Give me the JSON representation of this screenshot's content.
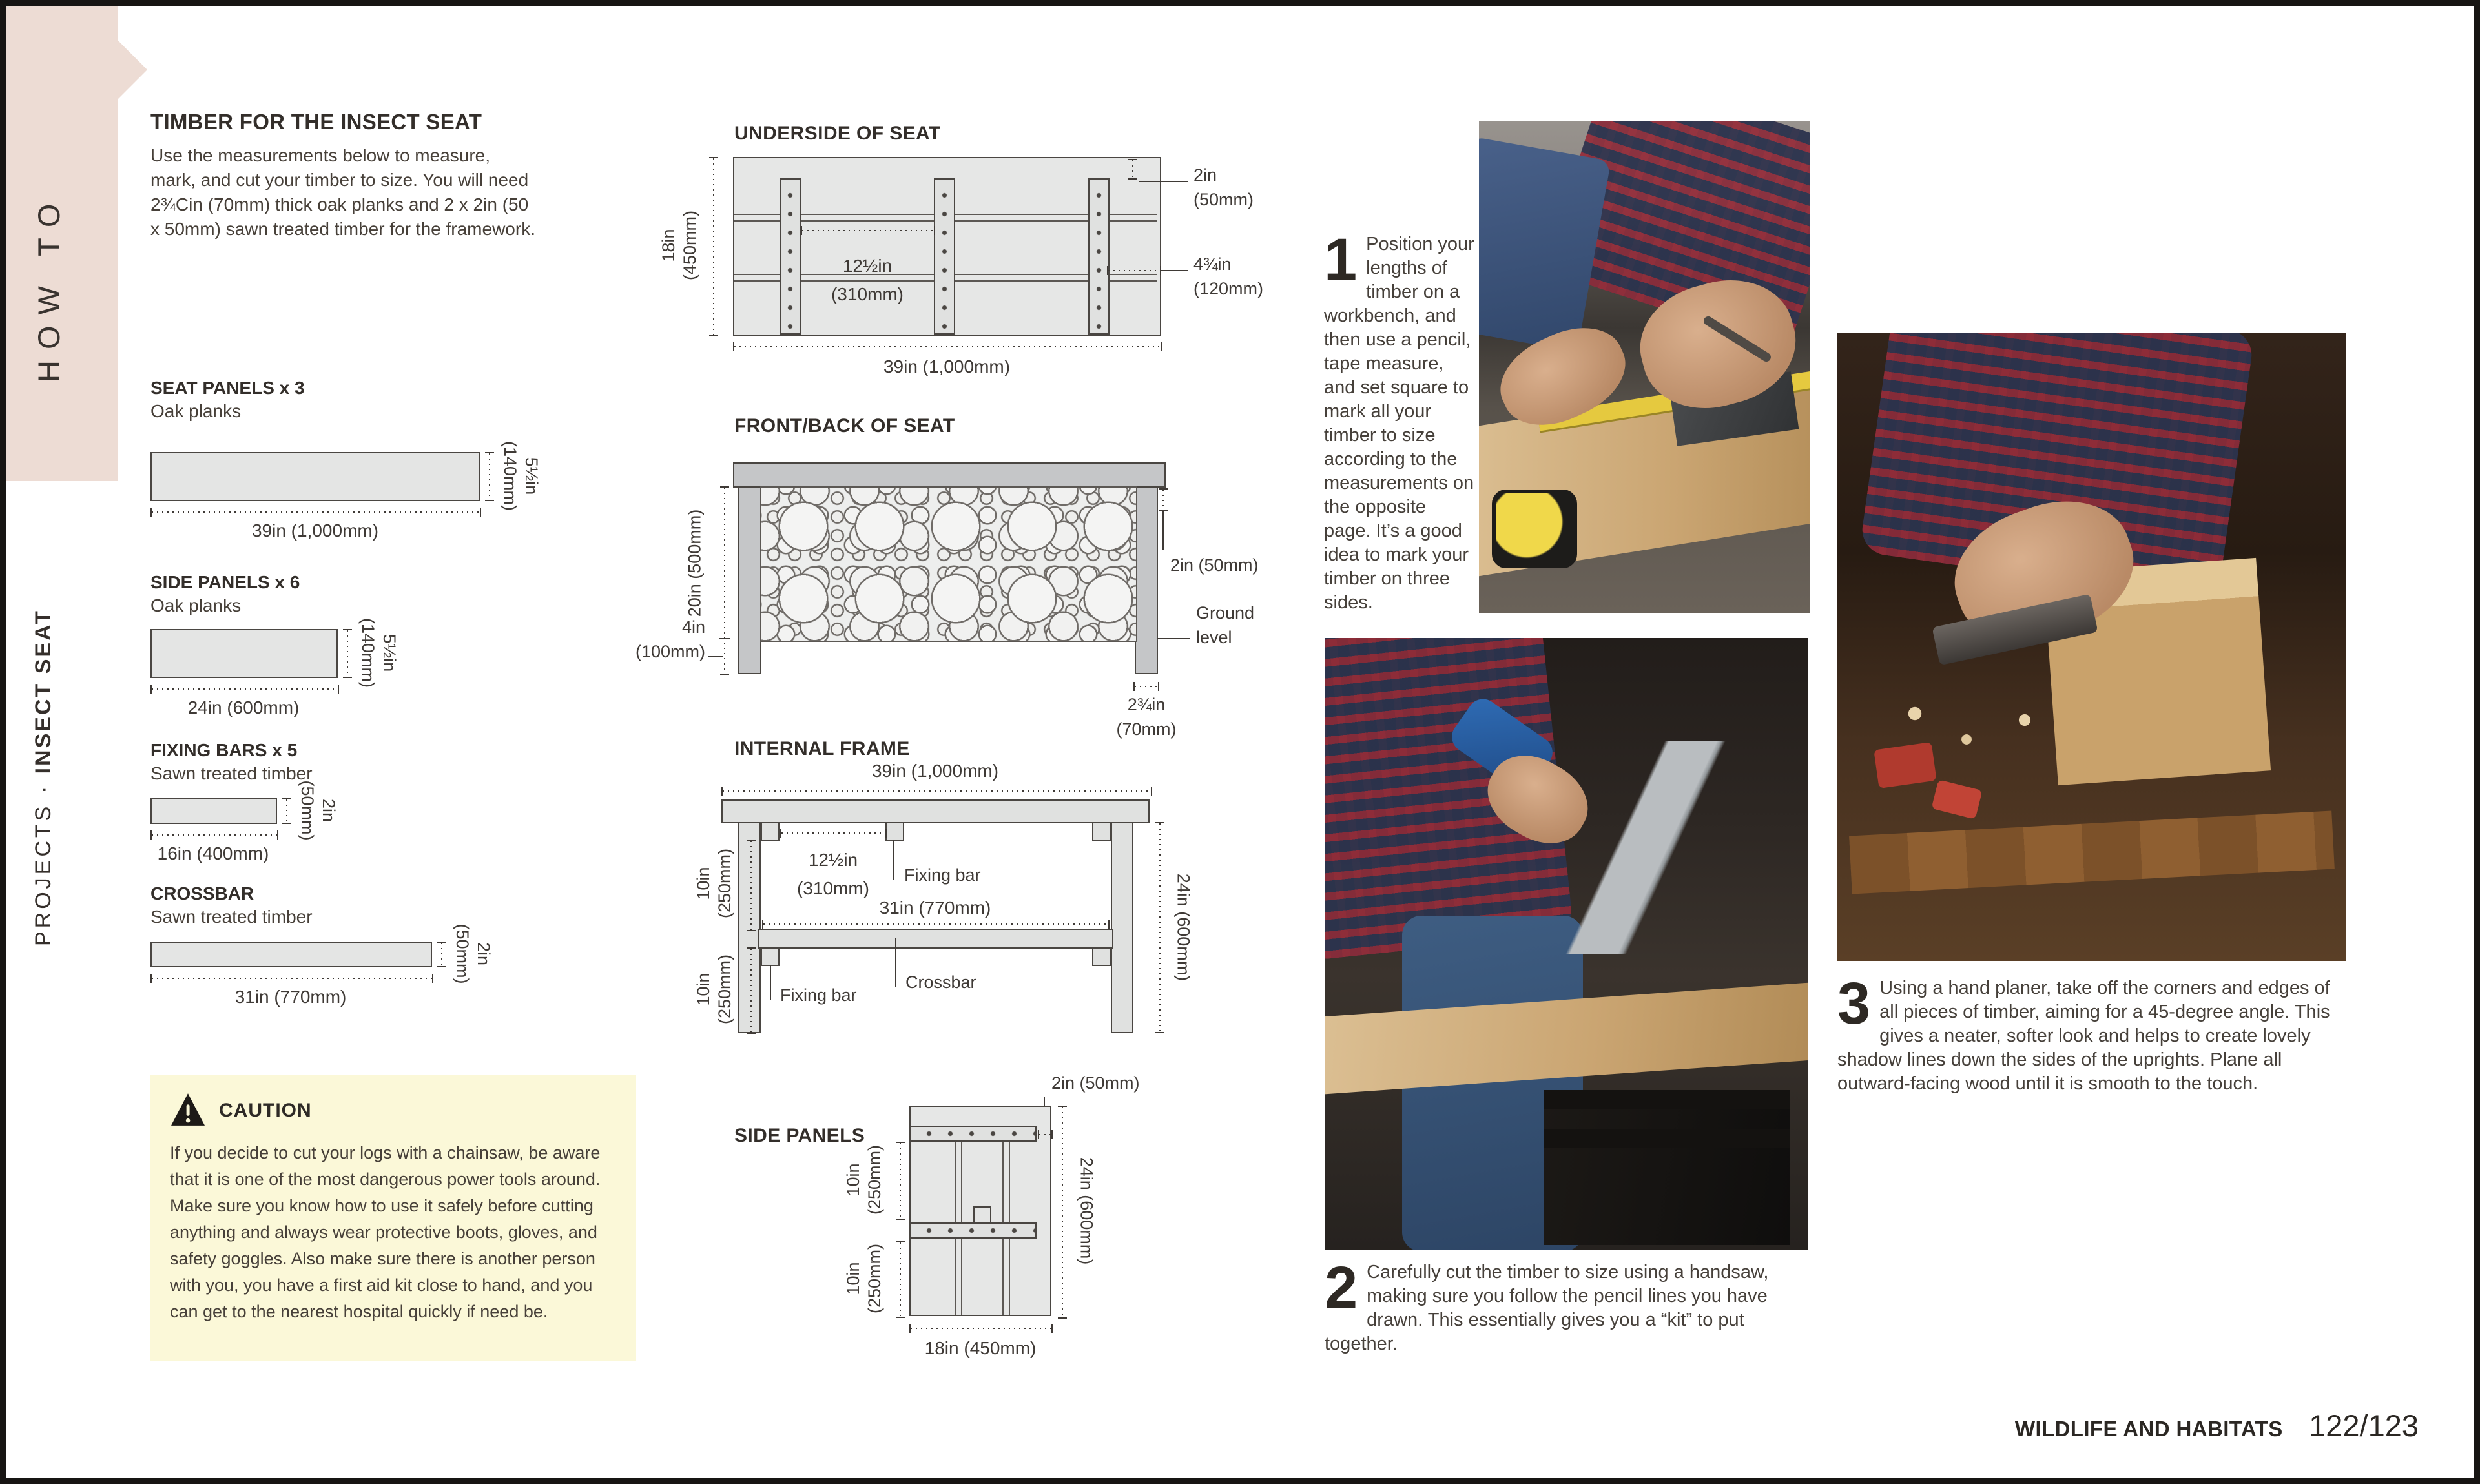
{
  "sidebar": {
    "ribbon_label": "HOW TO",
    "category": "PROJECTS",
    "separator": "·",
    "title": "INSECT SEAT"
  },
  "intro": {
    "heading": "TIMBER FOR THE INSECT SEAT",
    "body": "Use the measurements below to measure, mark, and cut your timber to size. You will need 2¾Cin (70mm) thick oak planks and 2 x 2in (50 x 50mm) sawn treated timber for the framework."
  },
  "cut_list": {
    "items": [
      {
        "name": "SEAT PANELS x 3",
        "material": "Oak planks",
        "length": "39in (1,000mm)",
        "w1": "5½in",
        "w2": "(140mm)"
      },
      {
        "name": "SIDE PANELS x 6",
        "material": "Oak planks",
        "length": "24in (600mm)",
        "w1": "5½in",
        "w2": "(140mm)"
      },
      {
        "name": "FIXING BARS x 5",
        "material": "Sawn treated timber",
        "length": "16in (400mm)",
        "w1": "2in",
        "w2": "(50mm)"
      },
      {
        "name": "CROSSBAR",
        "material": "Sawn treated timber",
        "length": "31in (770mm)",
        "w1": "2in",
        "w2": "(50mm)"
      }
    ]
  },
  "caution": {
    "title": "CAUTION",
    "body": "If you decide to cut your logs with a chainsaw, be aware that it is one of the most dangerous power tools around. Make sure you know how to use it safely before cutting anything and always wear protective boots, gloves, and safety goggles. Also make sure there is another person with you, you have a first aid kit close to hand, and you can get to the nearest hospital quickly if need be."
  },
  "underside": {
    "title": "UNDERSIDE OF SEAT",
    "h1": "18in",
    "h2": "(450mm)",
    "width": "39in (1,000mm)",
    "sp1": "12½in",
    "sp2": "(310mm)",
    "gap1": "2in",
    "gap2": "(50mm)",
    "edge1": "4¾in",
    "edge2": "(120mm)"
  },
  "frontback": {
    "title": "FRONT/BACK OF SEAT",
    "panel_height": "20in (500mm)",
    "below1": "4in",
    "below2": "(100mm)",
    "thickness": "2in (50mm)",
    "ground1": "Ground",
    "ground2": "level",
    "leg1": "2¾in",
    "leg2": "(70mm)"
  },
  "internal": {
    "title": "INTERNAL FRAME",
    "width": "39in (1,000mm)",
    "sp1": "12½in",
    "sp2": "(310mm)",
    "fixing_bar_upper": "Fixing bar",
    "inner_width": "31in (770mm)",
    "crossbar": "Crossbar",
    "fixing_bar_lower": "Fixing bar",
    "u1": "10in",
    "u2": "(250mm)",
    "l1": "10in",
    "l2": "(250mm)",
    "height": "24in (600mm)"
  },
  "sidepanels": {
    "title": "SIDE PANELS",
    "top_gap": "2in (50mm)",
    "u1": "10in",
    "u2": "(250mm)",
    "l1": "10in",
    "l2": "(250mm)",
    "height": "24in (600mm)",
    "width": "18in (450mm)"
  },
  "steps": [
    {
      "number": "1",
      "text": "Position your lengths of timber on a workbench, and then use a pencil, tape measure, and set square to mark all your timber to size according to the measurements on the opposite page. It’s a good idea to mark your timber on three sides."
    },
    {
      "number": "2",
      "text": "Carefully cut the timber to size using a handsaw, making sure you follow the pencil lines you have drawn. This essentially gives you a “kit” to put together."
    },
    {
      "number": "3",
      "text": "Using a hand planer, take off the corners and edges of all pieces of timber, aiming for a 45-degree angle. This gives a neater, softer look and helps to create lovely shadow lines down the sides of the uprights. Plane all outward-facing wood until it is smooth to the touch."
    }
  ],
  "footer": {
    "section": "WILDLIFE AND HABITATS",
    "pages": "122/123"
  }
}
